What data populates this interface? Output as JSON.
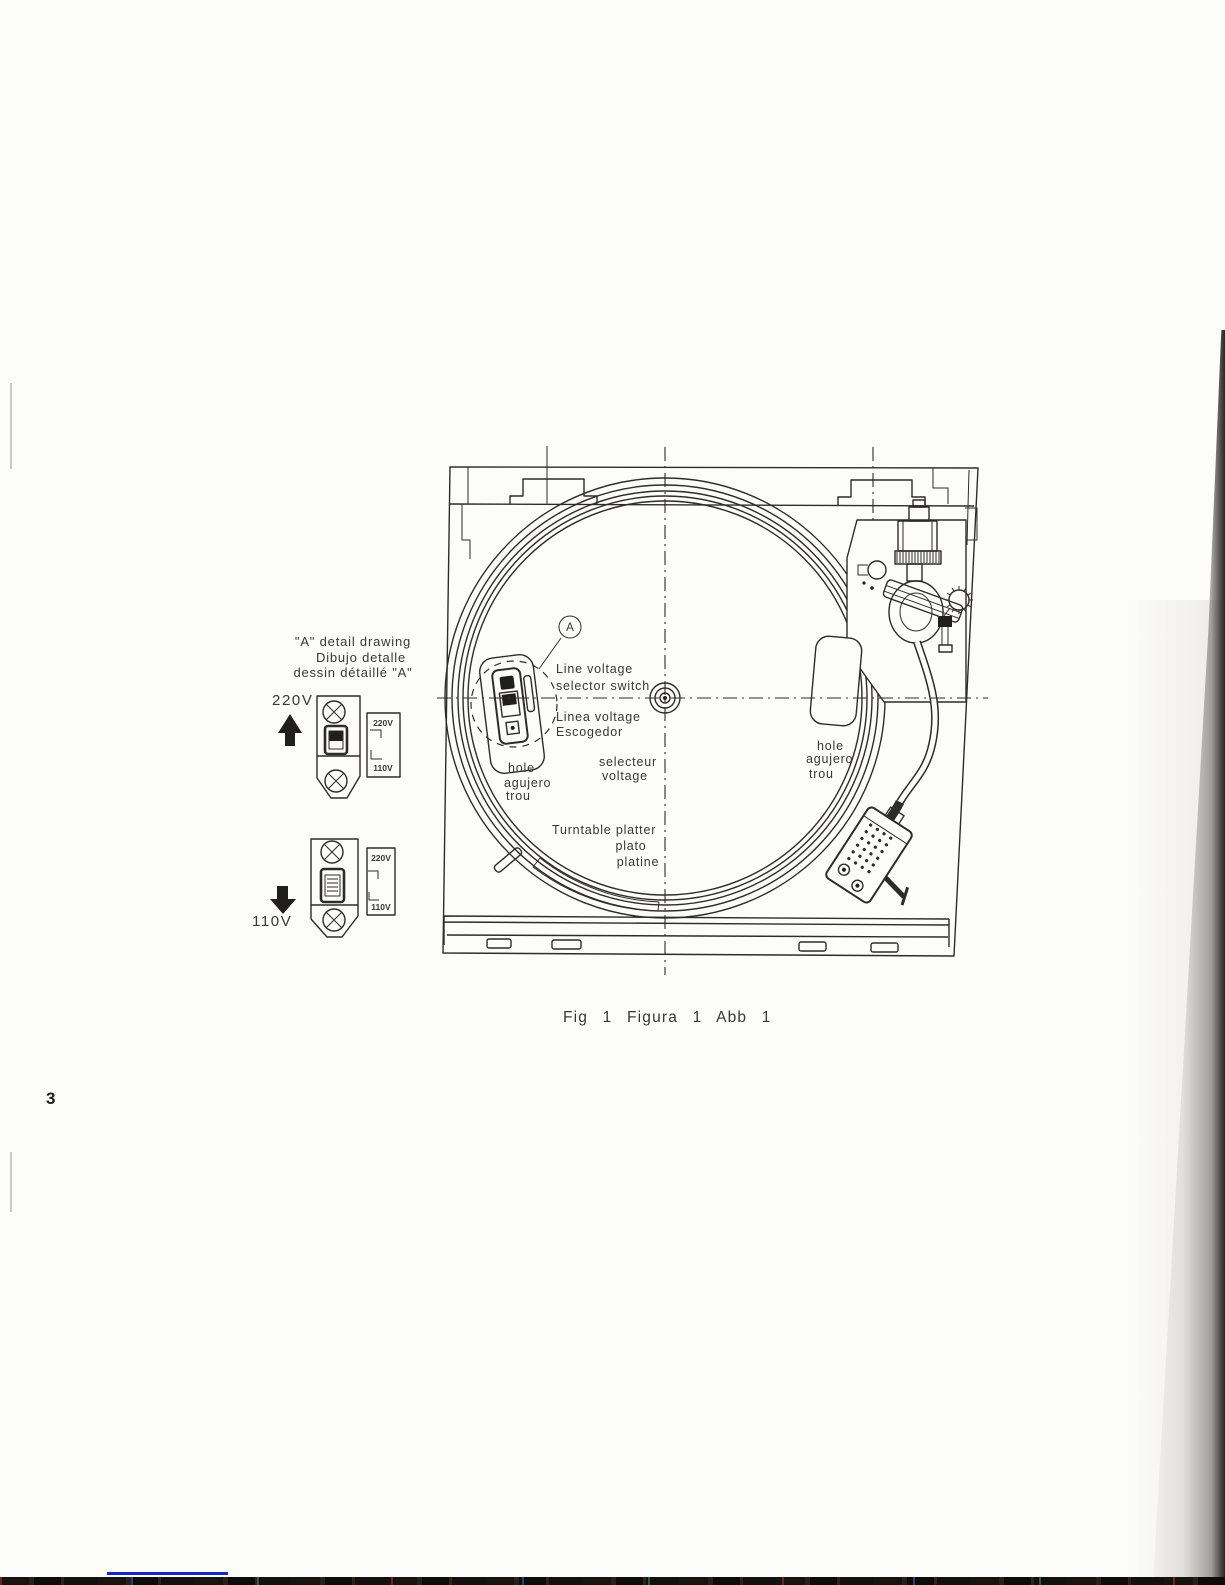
{
  "page": {
    "number": "3",
    "caption": "Fig 1 Figura 1 Abb 1",
    "paper_color": "#fcfcfb",
    "ink_color": "#2e2c2a",
    "accent_blue": "#1a23c4"
  },
  "detail": {
    "annotation": [
      "\"A\" detail drawing",
      "Dibujo detalle",
      "dessin détaillé \"A\""
    ],
    "v220": {
      "label": "220V",
      "arrow_icon": "up-arrow",
      "indicator_top": "220V",
      "indicator_bottom": "110V"
    },
    "v110": {
      "label": "110V",
      "arrow_icon": "down-arrow",
      "indicator_top": "220V",
      "indicator_bottom": "110V"
    }
  },
  "figure": {
    "marker": "A",
    "labels": {
      "selector_en": [
        "Line voltage",
        "selector switch"
      ],
      "selector_es": [
        "Linea voltage",
        "Escogedor"
      ],
      "selector_fr": [
        "selecteur",
        "voltage"
      ],
      "hole_left": [
        "hole",
        "agujero",
        "trou"
      ],
      "hole_right": [
        "hole",
        "agujero",
        "trou"
      ],
      "platter": [
        "Turntable platter",
        "plato",
        "platine"
      ]
    }
  }
}
